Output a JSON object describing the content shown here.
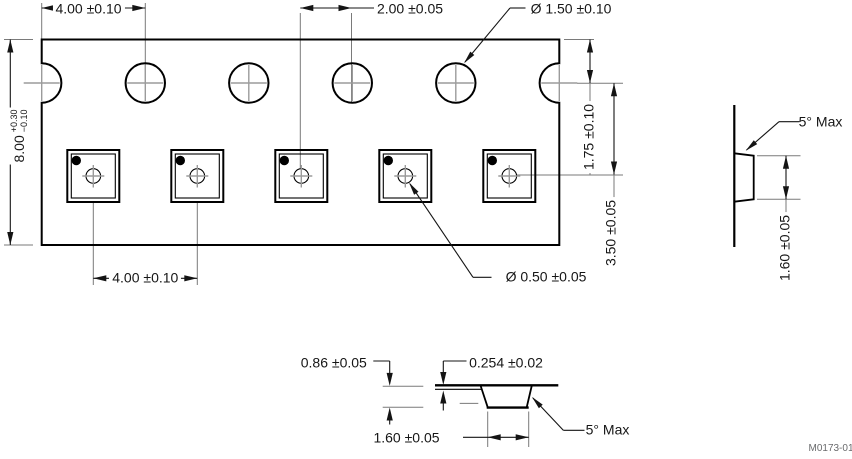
{
  "sheet": {
    "code": "M0173-01"
  },
  "front_view": {
    "sprocket_pitch": "4.00 ±0.10",
    "pocket_to_sprocket": "2.00 ±0.05",
    "sprocket_hole_dia": "Ø 1.50 ±0.10",
    "tape_width": "8.00",
    "tape_width_tol_plus": "+0.30",
    "tape_width_tol_minus": "−0.10",
    "edge_to_sprocket": "1.75 ±0.10",
    "sprocket_to_pocket_center": "3.50 ±0.05",
    "pocket_pitch": "4.00 ±0.10",
    "center_hole_dia": "Ø 0.50 ±0.05"
  },
  "side_view": {
    "draft_angle": "5° Max",
    "pocket_height": "1.60 ±0.05"
  },
  "section_view": {
    "pocket_depth": "0.86 ±0.05",
    "tape_thickness": "0.254 ±0.02",
    "pocket_width": "1.60 ±0.05",
    "draft_angle": "5° Max"
  }
}
